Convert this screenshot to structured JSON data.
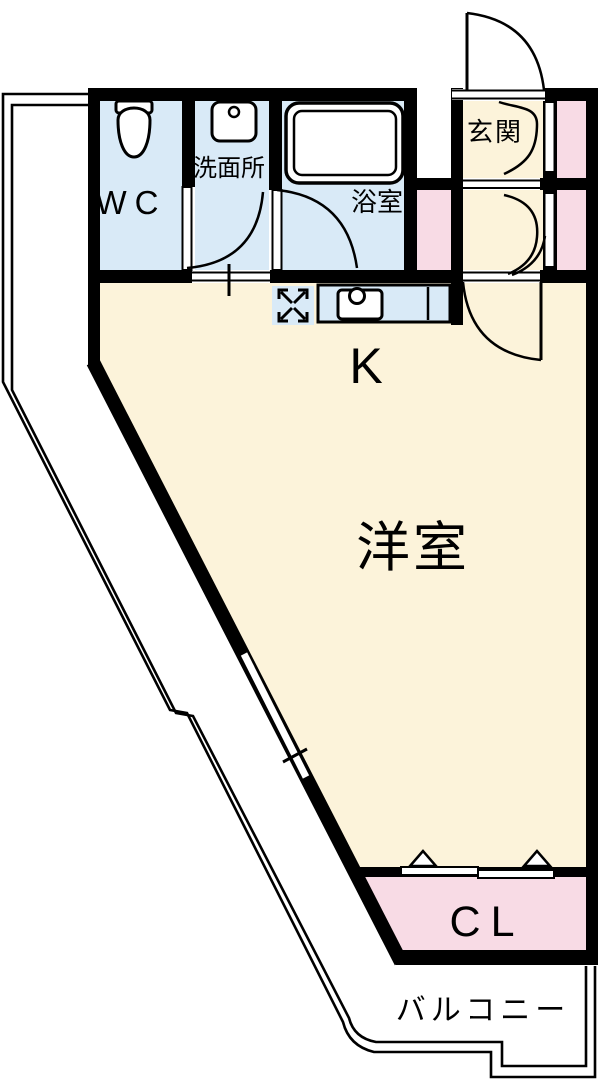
{
  "floorplan": {
    "rooms": {
      "wc": "WC",
      "washroom": "洗面所",
      "bathroom": "浴室",
      "entrance": "玄関",
      "kitchen": "K",
      "western_room": "洋室",
      "closet": "CL",
      "balcony": "バルコニー"
    },
    "colors": {
      "wet_area": "#D9EAF7",
      "room_cream": "#FCF3DA",
      "storage_pink": "#F8DBE5",
      "wall": "#000000",
      "fixture": "#FFFFFF"
    },
    "icons": {
      "toilet": "toilet-icon",
      "washbasin": "washbasin-icon",
      "bathtub": "bathtub-icon",
      "gas_stove": "gas-stove-icon",
      "kitchen_sink": "kitchen-sink-icon"
    }
  }
}
